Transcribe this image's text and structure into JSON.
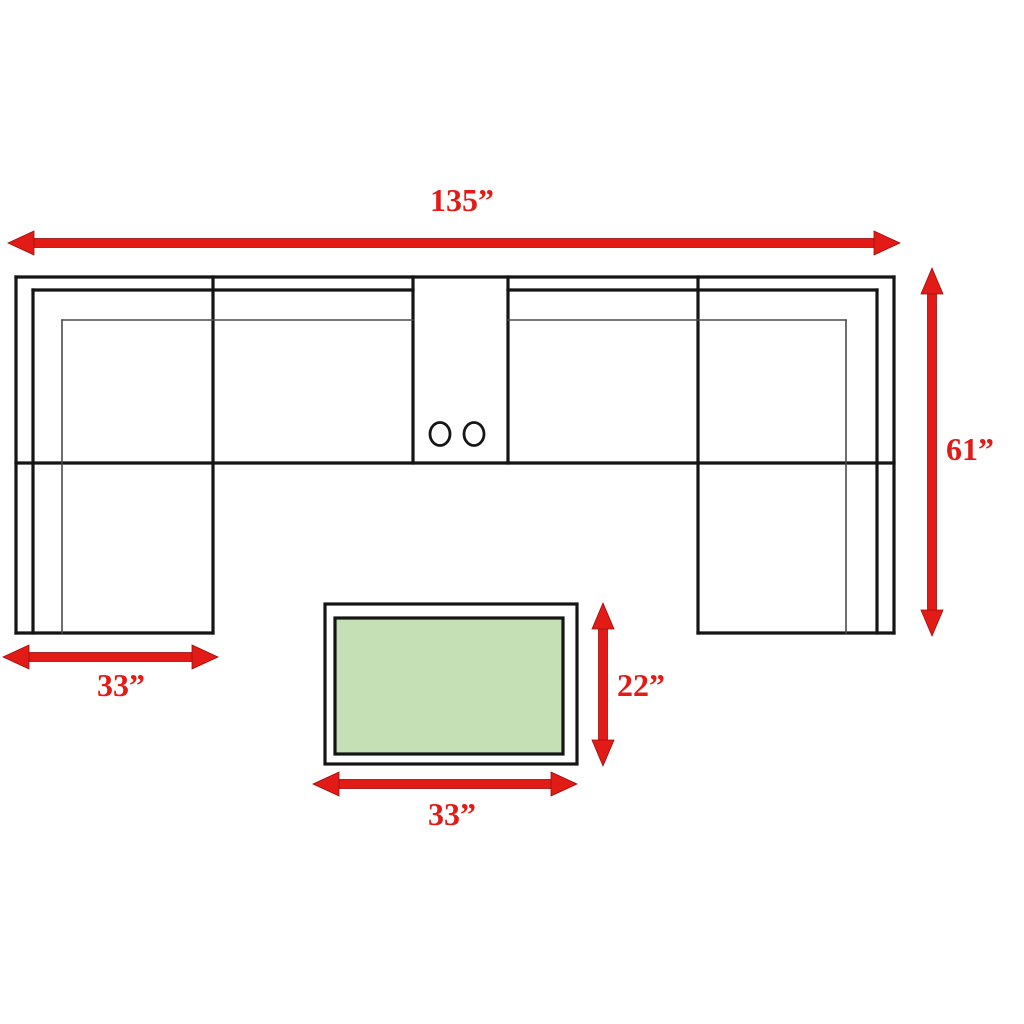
{
  "diagram": {
    "name": "sectional-sofa-and-coffee-table-dimension-diagram",
    "dimensions": {
      "sofa_width": "135”",
      "sofa_depth": "61”",
      "chaise_width": "33”",
      "table_depth": "22”",
      "table_width": "33”"
    },
    "colors": {
      "dimension_red": "#e21b17",
      "dimension_dark_red": "#9a0f0f",
      "outline_black": "#151515",
      "thin_gray": "#4a4a4a",
      "table_green": "#c6e0b6",
      "background": "#ffffff"
    }
  }
}
